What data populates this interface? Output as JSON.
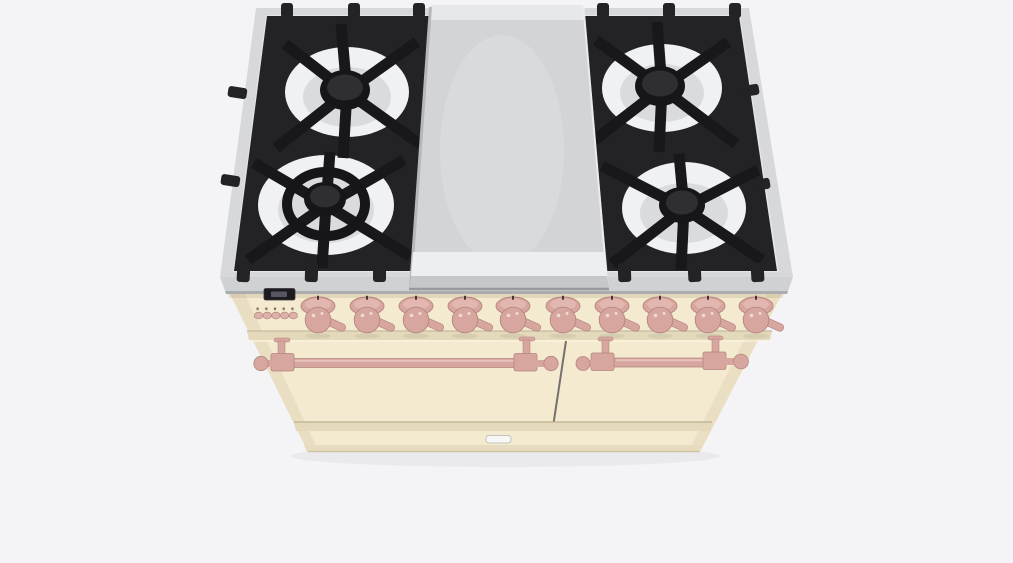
{
  "scene": {
    "type": "3d-product-render",
    "subject": "freestanding dual-oven range cooker with center griddle",
    "finish": "cream body with rose hardware",
    "view": "elevated front three-quarter"
  },
  "palette": {
    "bg": "#f4f4f6",
    "rim": "#d6d8da",
    "rimFace": "#cfd1d3",
    "rimEdge": "#aaacae",
    "deck": "#e4e5e7",
    "grate": "#232325",
    "grateDark": "#18181a",
    "cap": "#161618",
    "capHi": "#2e2e33",
    "bowl": "#f0f1f3",
    "bowlShade": "#d9dbdd",
    "griddle": "#d2d4d6",
    "griddleHi": "#eceeef",
    "griddleFace": "#c5c7c9",
    "griddleDark": "#97999b",
    "cream": "#f3ead0",
    "creamDark": "#e4d9bb",
    "creamDeep": "#d9cdab",
    "creamLine": "#c2b596",
    "pink": "#d7a69f",
    "pinkDark": "#b5867f",
    "pinkLight": "#ecc8c2",
    "btnPink": "#dfb1ab",
    "lcd": "#1b1b20",
    "lcdGlow": "#62626e",
    "split": "#5c5c5c",
    "latch": "#f7f7f5"
  },
  "cooktop": {
    "grates": "black cast iron",
    "burner_count": 4,
    "burners": [
      {
        "position": "rear-left",
        "type": "standard"
      },
      {
        "position": "front-left",
        "type": "large dual-ring"
      },
      {
        "position": "rear-right",
        "type": "standard"
      },
      {
        "position": "front-right",
        "type": "standard"
      }
    ],
    "center_module": "stainless steel griddle plate"
  },
  "control_panel": {
    "display": {
      "kind": "small dark lcd",
      "text": ""
    },
    "button_count": 5,
    "knob_count": 10
  },
  "ovens": {
    "door_count": 2,
    "handle_count": 2,
    "bottom_latch": true
  }
}
